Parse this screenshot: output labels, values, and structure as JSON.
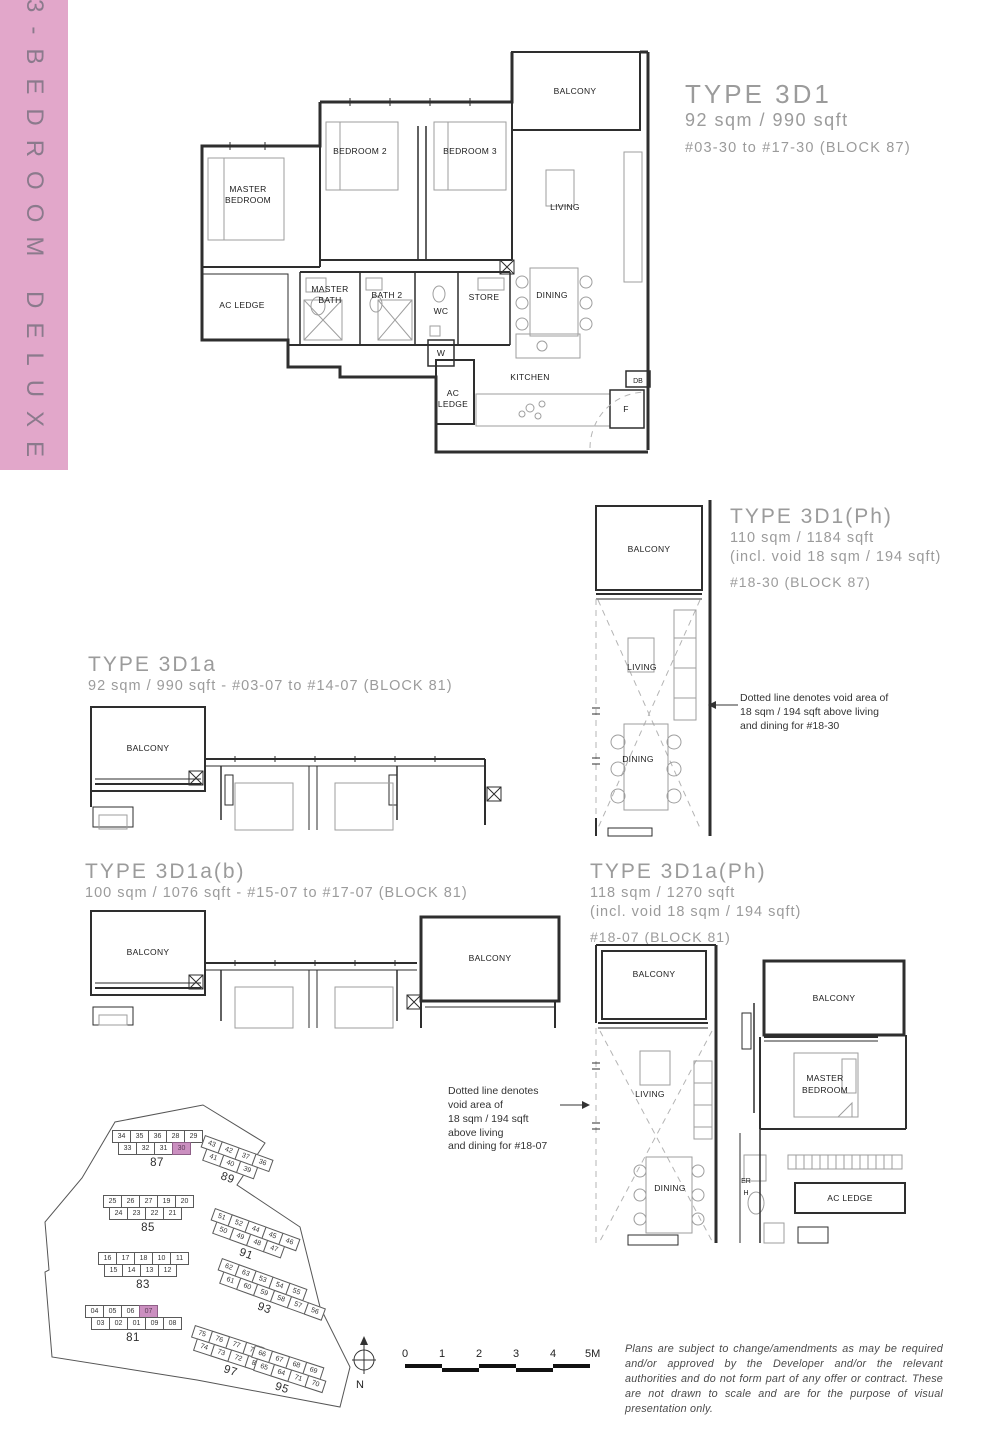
{
  "sidebar": {
    "label": "3-BEDROOM DELUXE"
  },
  "colors": {
    "banner_pink": "#e2a7ca",
    "highlight_pink": "#cb8fc0"
  },
  "plans": {
    "d1": {
      "title": "TYPE 3D1",
      "area": "92 sqm / 990 sqft",
      "units": "#03-30 to #17-30 (BLOCK 87)",
      "rooms": {
        "balcony": "BALCONY",
        "master_1": "MASTER",
        "master_2": "BEDROOM",
        "bedroom2": "BEDROOM 2",
        "bedroom3": "BEDROOM 3",
        "living": "LIVING",
        "ac_ledge": "AC LEDGE",
        "master_bath_1": "MASTER",
        "master_bath_2": "BATH",
        "bath2": "BATH 2",
        "wc": "WC",
        "store": "STORE",
        "dining": "DINING",
        "w": "W",
        "kitchen": "KITCHEN",
        "ac2_1": "AC",
        "ac2_2": "LEDGE",
        "f": "F",
        "db": "DB"
      }
    },
    "d1ph": {
      "title": "TYPE 3D1(Ph)",
      "area": "110 sqm / 1184 sqft",
      "void": "(incl. void 18 sqm / 194 sqft)",
      "units": "#18-30 (BLOCK 87)",
      "note_lines": [
        "Dotted line denotes void area of",
        "18 sqm / 194 sqft  above living",
        "and dining for #18-30"
      ],
      "rooms": {
        "balcony": "BALCONY",
        "living": "LIVING",
        "dining": "DINING"
      }
    },
    "d1a": {
      "title": "TYPE 3D1a",
      "subtitle": "92 sqm / 990 sqft - #03-07 to #14-07 (BLOCK 81)",
      "rooms": {
        "balcony": "BALCONY"
      }
    },
    "d1ab": {
      "title": "TYPE 3D1a(b)",
      "subtitle": "100 sqm / 1076 sqft - #15-07 to #17-07 (BLOCK 81)",
      "rooms": {
        "balcony": "BALCONY",
        "balcony2": "BALCONY"
      }
    },
    "d1aph": {
      "title": "TYPE 3D1a(Ph)",
      "area": "118 sqm / 1270 sqft",
      "void": "(incl. void 18 sqm / 194 sqft)",
      "units": "#18-07 (BLOCK 81)",
      "note_lines": [
        "Dotted line denotes void area of",
        "18 sqm / 194 sqft  above living",
        "and dining for #18-07"
      ],
      "rooms": {
        "balcony": "BALCONY",
        "balcony2": "BALCONY",
        "living": "LIVING",
        "dining": "DINING",
        "master_1": "MASTER",
        "master_2": "BEDROOM",
        "ac_ledge": "AC LEDGE",
        "frag_1": "ER",
        "frag_2": "H"
      }
    }
  },
  "siteplan": {
    "north_label": "N",
    "blocks": [
      {
        "label": "87",
        "rows": [
          [
            "34",
            "35",
            "36",
            "28",
            "29"
          ],
          [
            "33",
            "32",
            "31",
            "30"
          ]
        ],
        "highlight": "30"
      },
      {
        "label": "89",
        "rows": [
          [
            "43",
            "42",
            "37",
            "36"
          ],
          [
            "41",
            "40",
            "39"
          ]
        ],
        "highlight": ""
      },
      {
        "label": "85",
        "rows": [
          [
            "25",
            "26",
            "27",
            "19",
            "20"
          ],
          [
            "24",
            "23",
            "22",
            "21"
          ]
        ],
        "highlight": ""
      },
      {
        "label": "91",
        "rows": [
          [
            "51",
            "52",
            "44",
            "45",
            "46"
          ],
          [
            "50",
            "49",
            "48",
            "47"
          ]
        ],
        "highlight": ""
      },
      {
        "label": "83",
        "rows": [
          [
            "16",
            "17",
            "18",
            "10",
            "11"
          ],
          [
            "15",
            "14",
            "13",
            "12"
          ]
        ],
        "highlight": ""
      },
      {
        "label": "93",
        "rows": [
          [
            "62",
            "63",
            "53",
            "54",
            "55"
          ],
          [
            "61",
            "60",
            "59",
            "58",
            "57",
            "56"
          ]
        ],
        "highlight": ""
      },
      {
        "label": "81",
        "rows": [
          [
            "04",
            "05",
            "06",
            "07"
          ],
          [
            "03",
            "02",
            "01",
            "09",
            "08"
          ]
        ],
        "highlight": "07"
      },
      {
        "label": "97",
        "rows": [
          [
            "75",
            "76",
            "77",
            "78"
          ],
          [
            "74",
            "73",
            "72",
            "80",
            "79"
          ]
        ],
        "highlight": ""
      },
      {
        "label": "95",
        "rows": [
          [
            "66",
            "67",
            "68",
            "69"
          ],
          [
            "65",
            "64",
            "71",
            "70"
          ]
        ],
        "highlight": ""
      }
    ]
  },
  "scalebar": {
    "ticks": [
      "0",
      "1",
      "2",
      "3",
      "4",
      "5M"
    ]
  },
  "disclaimer": "Plans are subject to change/amendments as may be required and/or approved by the Developer and/or the relevant authorities and do not form part of any offer or contract. These are not drawn to scale and are for the purpose of visual presentation only."
}
